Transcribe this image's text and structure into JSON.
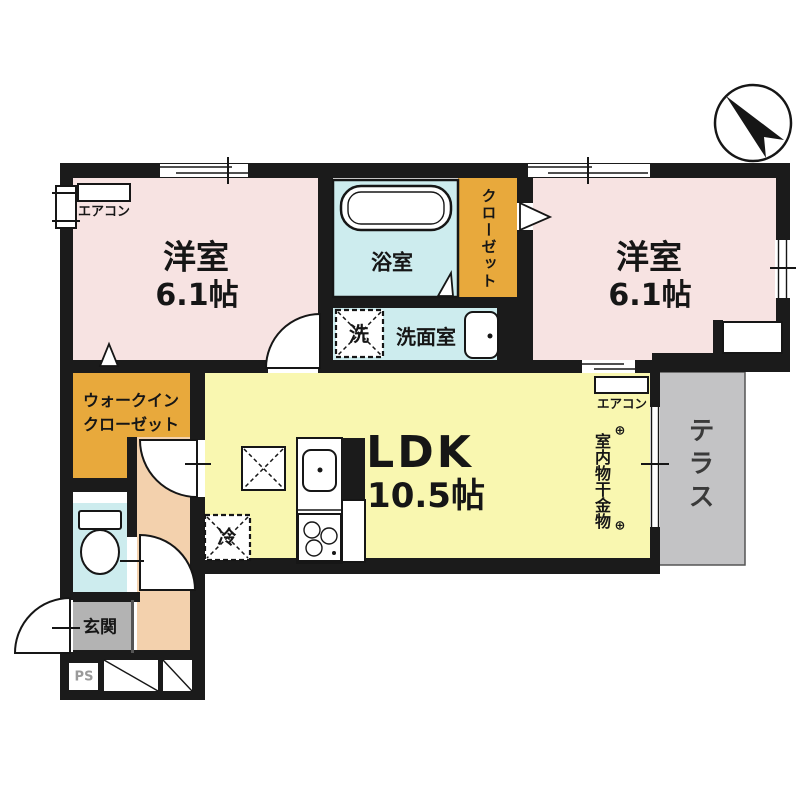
{
  "rooms": {
    "western_room_1": {
      "label": "洋室",
      "area": "6.1帖"
    },
    "western_room_2": {
      "label": "洋室",
      "area": "6.1帖"
    },
    "ldk": {
      "label": "LDK",
      "area": "10.5帖"
    },
    "bathroom": {
      "label": "浴室"
    },
    "washroom": {
      "label": "洗面室"
    },
    "closet": {
      "label": "クローゼット"
    },
    "walk_in_closet": {
      "line1": "ウォークイン",
      "line2": "クローゼット"
    },
    "entrance": {
      "label": "玄関"
    },
    "terrace": {
      "label": "テラス"
    },
    "pipe_space": {
      "label": "PS"
    }
  },
  "equipment": {
    "aircon_room1": "エアコン",
    "aircon_ldk": "エアコン",
    "washing_machine": "洗",
    "refrigerator": "冷",
    "indoor_laundry_hardware": "室内物干金物",
    "hook_symbol_top": "⊕",
    "hook_symbol_bottom": "⊕"
  },
  "colors": {
    "wall": "#1b1b1b",
    "room_pink": "#f7e3e2",
    "ldk_yellow": "#f9f7b0",
    "closet_orange": "#e8a93c",
    "wet_blue": "#cdecee",
    "hall_peach": "#f3d1ad",
    "entrance_gray": "#b3b3b3",
    "terrace_gray": "#c3c3c5",
    "ps_gray": "#9a9a9a"
  }
}
